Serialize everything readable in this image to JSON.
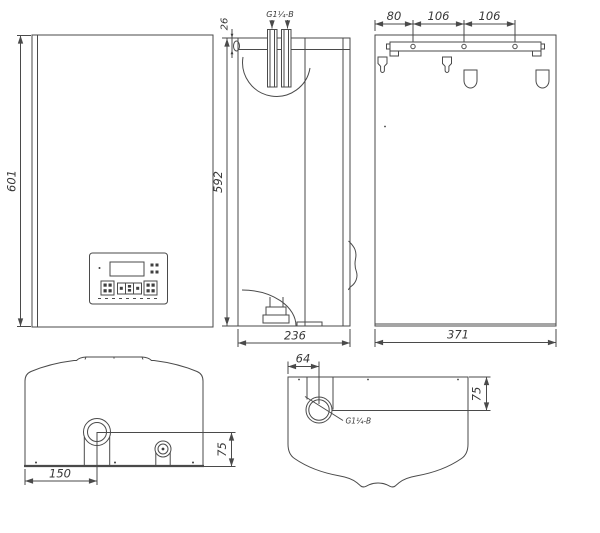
{
  "drawing": {
    "colors": {
      "line": "#4a4a4a",
      "text": "#383838",
      "background": "#ffffff"
    },
    "views": {
      "front": {
        "height_label": "601"
      },
      "side": {
        "height_label": "592",
        "depth_label": "236",
        "pipe_top_offset_label": "26",
        "pipe_thread_label": "G1¼-B"
      },
      "back": {
        "width_label": "371",
        "spacing_labels": [
          "80",
          "106",
          "106"
        ]
      },
      "bottom": {
        "pipe_offset_x_label": "150",
        "pipe_offset_y_label": "75"
      },
      "top": {
        "pipe_offset_x_label": "64",
        "pipe_offset_y_label": "75",
        "pipe_thread_label": "G1¼-B"
      }
    }
  }
}
